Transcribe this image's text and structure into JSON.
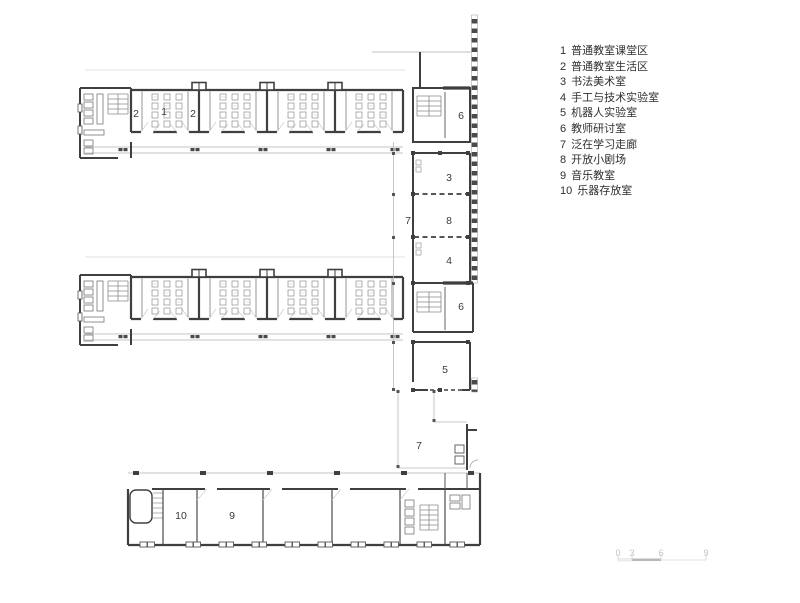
{
  "legend": {
    "items": [
      {
        "num": "1",
        "label": "普通教室课堂区"
      },
      {
        "num": "2",
        "label": "普通教室生活区"
      },
      {
        "num": "3",
        "label": "书法美术室"
      },
      {
        "num": "4",
        "label": "手工与技术实验室"
      },
      {
        "num": "5",
        "label": "机器人实验室"
      },
      {
        "num": "6",
        "label": "教师研讨室"
      },
      {
        "num": "7",
        "label": "泛在学习走廊"
      },
      {
        "num": "8",
        "label": "开放小剧场"
      },
      {
        "num": "9",
        "label": "音乐教室"
      },
      {
        "num": "10",
        "label": "乐器存放室"
      }
    ]
  },
  "plan": {
    "room_labels": [
      {
        "room": "living-area-left",
        "text": "2"
      },
      {
        "room": "teaching-area",
        "text": "1"
      },
      {
        "room": "living-area-right",
        "text": "2"
      },
      {
        "room": "teacher-seminar-upper",
        "text": "6"
      },
      {
        "room": "calligraphy-art-room",
        "text": "3"
      },
      {
        "room": "learning-corridor-upper",
        "text": "7"
      },
      {
        "room": "open-theater",
        "text": "8"
      },
      {
        "room": "craft-tech-lab",
        "text": "4"
      },
      {
        "room": "teacher-seminar-lower",
        "text": "6"
      },
      {
        "room": "robotics-lab",
        "text": "5"
      },
      {
        "room": "learning-corridor-lower",
        "text": "7"
      },
      {
        "room": "instrument-storage",
        "text": "10"
      },
      {
        "room": "music-room",
        "text": "9"
      }
    ]
  },
  "scale_bar": {
    "ticks": [
      "0",
      "3",
      "6",
      "9"
    ]
  },
  "colors": {
    "wall": "#3f3f3f",
    "light_line": "#b3b3b3",
    "furniture": "#8f8f8f",
    "label_text": "#3a3a3a",
    "scale_text": "#c4c4c4"
  }
}
